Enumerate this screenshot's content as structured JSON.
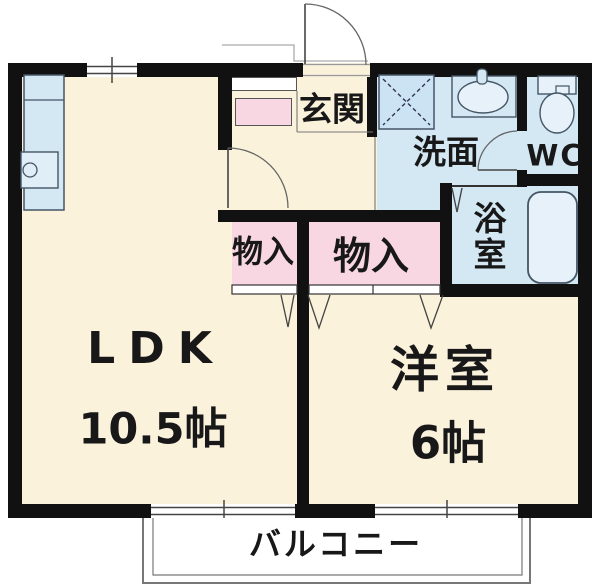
{
  "plan": {
    "entrance_label": "玄関",
    "washroom_label": "洗面",
    "toilet_label": "WC",
    "bathroom_label": "浴室",
    "closet_left_label": "物入",
    "closet_right_label": "物入",
    "ldk_name": "LDK",
    "ldk_size": "10.5帖",
    "western_room_name": "洋室",
    "western_room_size": "6帖",
    "balcony_label": "バルコニー"
  },
  "colors": {
    "room_cream": "#FBF2DC",
    "wet_area_blue": "#D4E8F4",
    "closet_pink": "#F8D7E2",
    "fixture_light_blue": "#E6F1F9",
    "wall_black": "#111111"
  },
  "icons": [
    "entrance-door-arc-icon",
    "ldk-door-arc-icon",
    "washroom-door-arc-icon",
    "bath-folding-door-icon",
    "kitchen-counter-icon",
    "kitchen-sink-icon",
    "washer-pan-icon",
    "vanity-sink-icon",
    "toilet-icon",
    "bathtub-icon",
    "window-icon",
    "closet-door-mark-icon",
    "balcony-outline-icon"
  ]
}
